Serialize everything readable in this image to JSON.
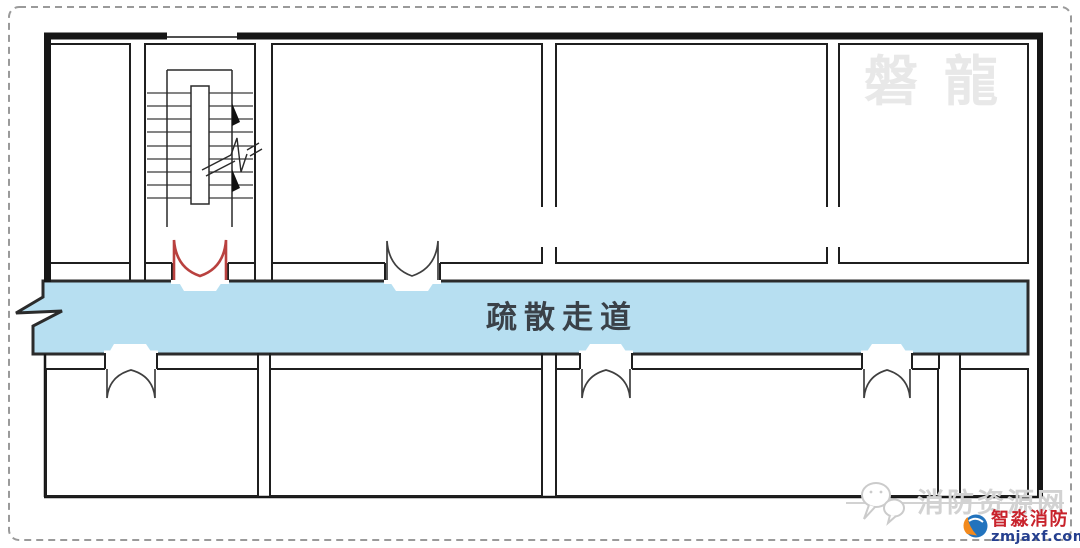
{
  "page": {
    "background_color": "#ffffff",
    "border_color": "#999999"
  },
  "plan": {
    "type": "fire-evacuation-floor-plan",
    "corridor": {
      "label": "疏散走道",
      "fill_color": "#b7dff1",
      "label_color": "#3a4148"
    },
    "wall_color": "#1f1f1f",
    "fire_door_color": "#b9413f",
    "rooms_top_count": 4,
    "rooms_bottom_count": 4,
    "features": {
      "stairwell": "top-left with treads, handrail, up/down run arrows and break line",
      "corridor_break_symbol": "zigzag continuation arrow at left end of corridor"
    }
  },
  "watermarks": {
    "top_right": "磐龍",
    "site_name": "消防资源网"
  },
  "logo": {
    "brand": "智淼消防",
    "domain": "zmjaxf.com",
    "brand_color": "#c8232c",
    "domain_color": "#253f8f"
  }
}
